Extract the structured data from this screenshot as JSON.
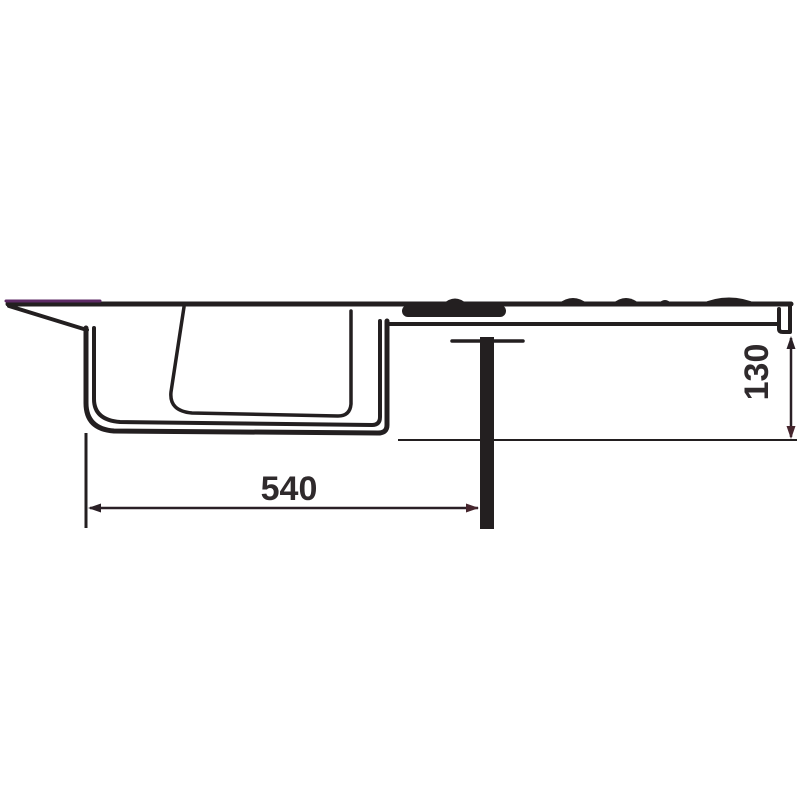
{
  "meta": {
    "title": "Sink cross-section dimension drawing",
    "type": "technical-drawing"
  },
  "drawing": {
    "dimensions": {
      "width_label": "540",
      "height_label": "130"
    },
    "colors": {
      "line": "#231f20",
      "dimension_line": "#2a2026",
      "dimension_text": "#2f2a2c",
      "accent_purple": "#5e2a66",
      "arrow_maroon": "#46262e",
      "background": "#ffffff"
    }
  }
}
